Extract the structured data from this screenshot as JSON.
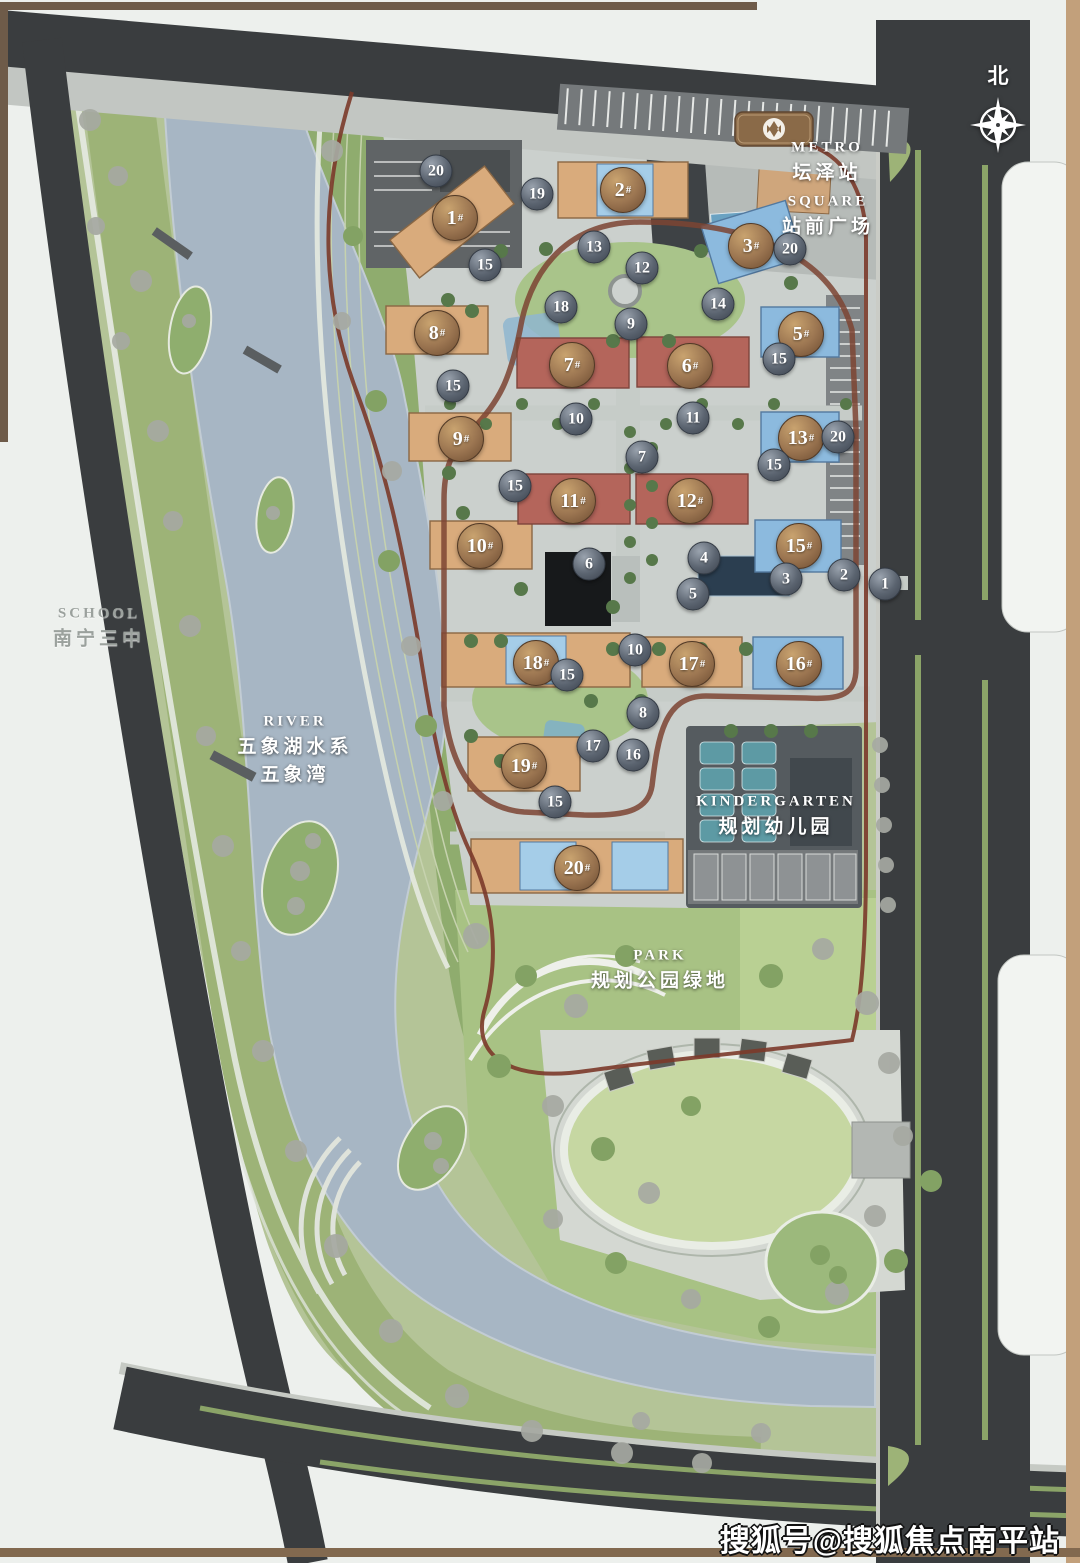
{
  "compass": {
    "label": "北"
  },
  "watermark": {
    "text": "搜狐号@搜狐焦点南平站"
  },
  "building_label_suffix": "#",
  "palette": {
    "building_tan": "#d9ab7c",
    "building_red": "#b4655b",
    "building_blue": "#8cbade",
    "marker_brown": "#9a7450",
    "marker_gray": "#5b6470",
    "river": "#a7b6c4",
    "road": "#3a3d3f",
    "boundary_red": "#7b3a2a",
    "frame_brown": "#6e5b49"
  },
  "landmarks": [
    {
      "id": "metro",
      "en": "METRO",
      "zh": [
        "坛泽站"
      ],
      "x": 827,
      "y": 162,
      "tone": "light"
    },
    {
      "id": "square",
      "en": "SQUARE",
      "zh": [
        "站前广场"
      ],
      "x": 828,
      "y": 216,
      "tone": "light"
    },
    {
      "id": "school",
      "en": "SCHOOL",
      "zh": [
        "南宁三中"
      ],
      "x": 99,
      "y": 628,
      "tone": "muted"
    },
    {
      "id": "river",
      "en": "RIVER",
      "zh": [
        "五象湖水系",
        "五象湾"
      ],
      "x": 295,
      "y": 750,
      "tone": "light"
    },
    {
      "id": "kindergarten",
      "en": "KINDERGARTEN",
      "zh": [
        "规划幼儿园"
      ],
      "x": 776,
      "y": 816,
      "tone": "light"
    },
    {
      "id": "park",
      "en": "PARK",
      "zh": [
        "规划公园绿地"
      ],
      "x": 660,
      "y": 970,
      "tone": "light"
    }
  ],
  "buildings": [
    {
      "num": "1",
      "x": 455,
      "y": 218
    },
    {
      "num": "2",
      "x": 623,
      "y": 190
    },
    {
      "num": "3",
      "x": 751,
      "y": 246
    },
    {
      "num": "5",
      "x": 801,
      "y": 334
    },
    {
      "num": "6",
      "x": 690,
      "y": 366
    },
    {
      "num": "7",
      "x": 572,
      "y": 365
    },
    {
      "num": "8",
      "x": 437,
      "y": 333
    },
    {
      "num": "9",
      "x": 461,
      "y": 439
    },
    {
      "num": "10",
      "x": 480,
      "y": 546
    },
    {
      "num": "11",
      "x": 573,
      "y": 501
    },
    {
      "num": "12",
      "x": 690,
      "y": 501
    },
    {
      "num": "13",
      "x": 801,
      "y": 438
    },
    {
      "num": "15",
      "x": 799,
      "y": 546
    },
    {
      "num": "16",
      "x": 799,
      "y": 664
    },
    {
      "num": "17",
      "x": 692,
      "y": 664
    },
    {
      "num": "18",
      "x": 536,
      "y": 663
    },
    {
      "num": "19",
      "x": 524,
      "y": 766
    },
    {
      "num": "20",
      "x": 577,
      "y": 868
    }
  ],
  "amenities": [
    {
      "num": "20",
      "x": 436,
      "y": 171
    },
    {
      "num": "19",
      "x": 537,
      "y": 194
    },
    {
      "num": "15",
      "x": 485,
      "y": 265
    },
    {
      "num": "13",
      "x": 594,
      "y": 247
    },
    {
      "num": "12",
      "x": 642,
      "y": 268
    },
    {
      "num": "18",
      "x": 561,
      "y": 307
    },
    {
      "num": "9",
      "x": 631,
      "y": 324
    },
    {
      "num": "14",
      "x": 718,
      "y": 304
    },
    {
      "num": "20",
      "x": 790,
      "y": 249
    },
    {
      "num": "15",
      "x": 779,
      "y": 359
    },
    {
      "num": "15",
      "x": 453,
      "y": 386
    },
    {
      "num": "10",
      "x": 576,
      "y": 419
    },
    {
      "num": "11",
      "x": 693,
      "y": 418
    },
    {
      "num": "7",
      "x": 642,
      "y": 457
    },
    {
      "num": "15",
      "x": 515,
      "y": 486
    },
    {
      "num": "20",
      "x": 838,
      "y": 437
    },
    {
      "num": "15",
      "x": 774,
      "y": 465
    },
    {
      "num": "6",
      "x": 589,
      "y": 564
    },
    {
      "num": "4",
      "x": 704,
      "y": 558
    },
    {
      "num": "5",
      "x": 693,
      "y": 594
    },
    {
      "num": "3",
      "x": 786,
      "y": 579
    },
    {
      "num": "2",
      "x": 844,
      "y": 575
    },
    {
      "num": "1",
      "x": 885,
      "y": 584
    },
    {
      "num": "10",
      "x": 635,
      "y": 650
    },
    {
      "num": "15",
      "x": 567,
      "y": 675
    },
    {
      "num": "8",
      "x": 643,
      "y": 713
    },
    {
      "num": "17",
      "x": 593,
      "y": 746
    },
    {
      "num": "16",
      "x": 633,
      "y": 755
    },
    {
      "num": "15",
      "x": 555,
      "y": 802
    }
  ]
}
